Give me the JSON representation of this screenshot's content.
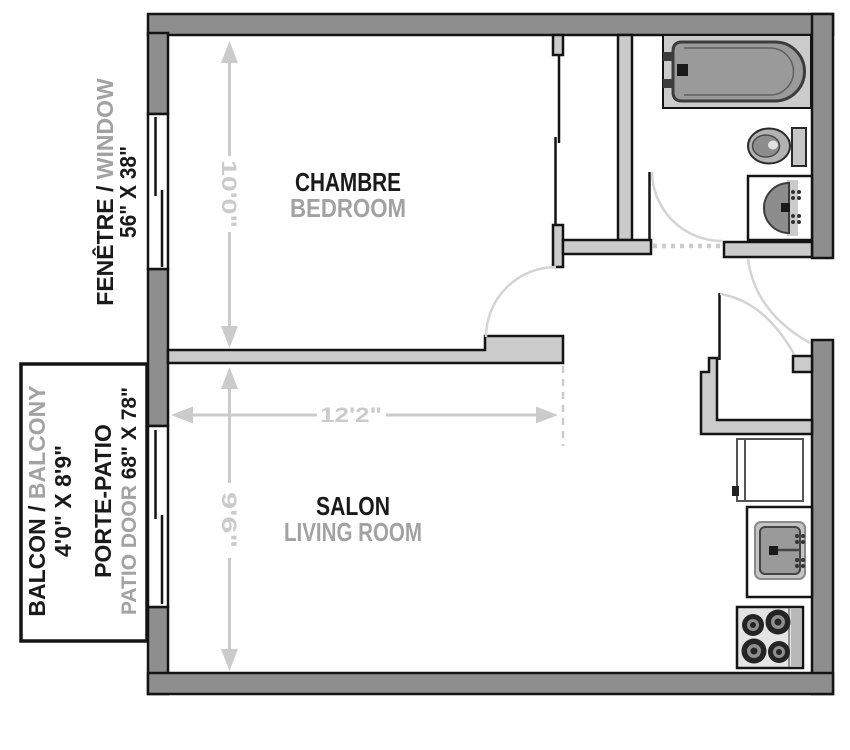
{
  "colors": {
    "outer_wall": "#8e8e8e",
    "inner_wall": "#cbcbcb",
    "outline": "#141414",
    "text_black": "#1a1a1a",
    "text_gray": "#a2a2a2",
    "dimension_gray": "#cbcbcb",
    "fixture_gray": "#9a9a9a"
  },
  "rooms": {
    "bedroom": {
      "label_fr": "CHAMBRE",
      "label_en": "BEDROOM"
    },
    "living_room": {
      "label_fr": "SALON",
      "label_en": "LIVING ROOM"
    }
  },
  "dimensions": {
    "bedroom_depth": "10'0\"",
    "unit_width": "12'2\"",
    "living_depth": "9'6\""
  },
  "labels": {
    "window": {
      "fr": "FENÊTRE / ",
      "en": "WINDOW",
      "size": "56\" X 38\""
    },
    "balcony": {
      "fr": "BALCON / ",
      "en": "BALCONY",
      "size": "4'0\" X 8'9\""
    },
    "patio": {
      "fr": "PORTE-PATIO",
      "en": "PATIO DOOR ",
      "size": "68\" X 78\""
    }
  },
  "fixtures": {
    "bathroom": [
      "bathtub",
      "toilet",
      "vanity-sink"
    ],
    "kitchen": [
      "refrigerator",
      "kitchen-sink",
      "stove"
    ],
    "other": [
      "entry-closet",
      "bedroom-window",
      "patio-door",
      "balcony"
    ]
  }
}
